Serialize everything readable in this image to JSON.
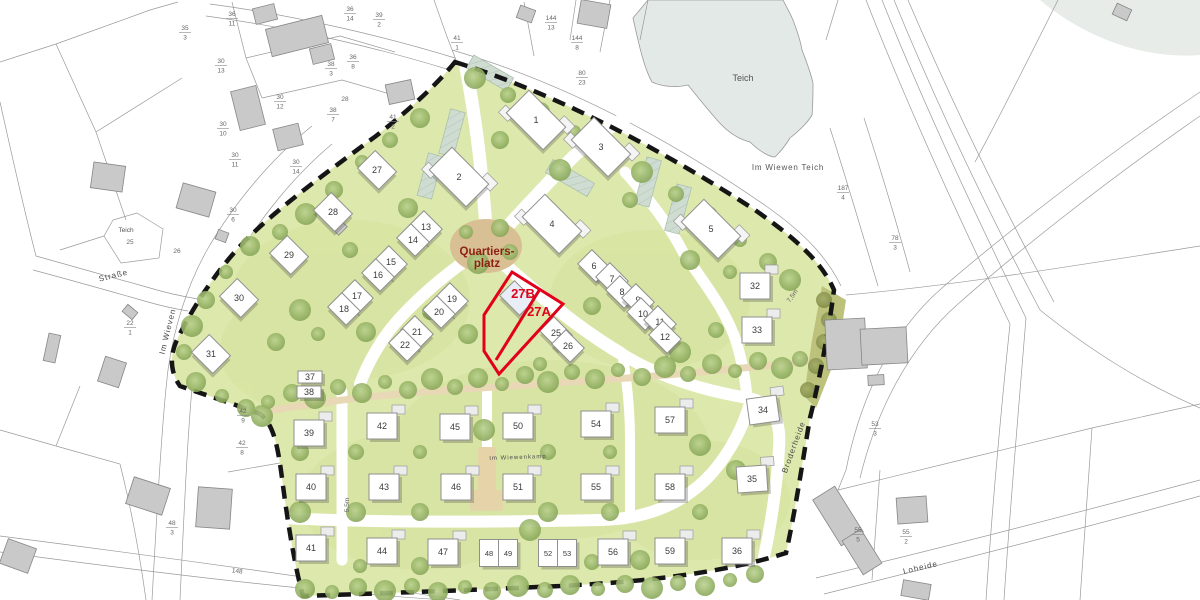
{
  "map": {
    "plaza": {
      "line1": "Quartiers-",
      "line2": "platz",
      "x": 487,
      "y": 255,
      "color": "#8e2012"
    },
    "highlight": {
      "color": "#e2001a",
      "plots": [
        {
          "label": "27B",
          "x": 523,
          "y": 298
        },
        {
          "label": "27A",
          "x": 539,
          "y": 316
        }
      ]
    },
    "water": {
      "pond_label": "Teich",
      "pond_x": 743,
      "pond_y": 81,
      "field_label": "Im Wiewen Teich",
      "field_x": 788,
      "field_y": 170,
      "small_pond_label": "Teich",
      "small_x": 126,
      "small_y": 232
    },
    "streets": [
      {
        "name": "Im Wieven",
        "x": 170,
        "y": 332,
        "rot": -76,
        "size": 8
      },
      {
        "name": "Straße",
        "x": 114,
        "y": 278,
        "rot": -14,
        "size": 8
      },
      {
        "name": "Broderheide",
        "x": 796,
        "y": 448,
        "rot": -70,
        "size": 8
      },
      {
        "name": "Loheide",
        "x": 921,
        "y": 570,
        "rot": -13,
        "size": 8
      },
      {
        "name": "Im Wiewenkamp",
        "x": 518,
        "y": 459,
        "rot": -2,
        "size": 6
      }
    ],
    "houses": [
      {
        "n": "1",
        "x": 536,
        "y": 120,
        "t": "b"
      },
      {
        "n": "2",
        "x": 459,
        "y": 177,
        "t": "b"
      },
      {
        "n": "3",
        "x": 601,
        "y": 147,
        "t": "b"
      },
      {
        "n": "4",
        "x": 552,
        "y": 224,
        "t": "b"
      },
      {
        "n": "5",
        "x": 711,
        "y": 229,
        "t": "b"
      },
      {
        "n": "6",
        "x": 594,
        "y": 266,
        "t": "r"
      },
      {
        "n": "7",
        "x": 612,
        "y": 279,
        "t": "r"
      },
      {
        "n": "8",
        "x": 622,
        "y": 292,
        "t": "r"
      },
      {
        "n": "9",
        "x": 638,
        "y": 300,
        "t": "r"
      },
      {
        "n": "10",
        "x": 643,
        "y": 314,
        "t": "r"
      },
      {
        "n": "11",
        "x": 660,
        "y": 322,
        "t": "r"
      },
      {
        "n": "12",
        "x": 665,
        "y": 337,
        "t": "r"
      },
      {
        "n": "13",
        "x": 426,
        "y": 227,
        "t": "r"
      },
      {
        "n": "14",
        "x": 413,
        "y": 240,
        "t": "r"
      },
      {
        "n": "15",
        "x": 391,
        "y": 262,
        "t": "r"
      },
      {
        "n": "16",
        "x": 378,
        "y": 275,
        "t": "r"
      },
      {
        "n": "17",
        "x": 357,
        "y": 296,
        "t": "r"
      },
      {
        "n": "18",
        "x": 344,
        "y": 309,
        "t": "r"
      },
      {
        "n": "19",
        "x": 452,
        "y": 299,
        "t": "r"
      },
      {
        "n": "20",
        "x": 439,
        "y": 312,
        "t": "r"
      },
      {
        "n": "21",
        "x": 417,
        "y": 332,
        "t": "r"
      },
      {
        "n": "22",
        "x": 405,
        "y": 345,
        "t": "r"
      },
      {
        "n": "25",
        "x": 556,
        "y": 333,
        "t": "r"
      },
      {
        "n": "26",
        "x": 568,
        "y": 346,
        "t": "r"
      },
      {
        "n": "27",
        "x": 377,
        "y": 170,
        "t": "d"
      },
      {
        "n": "28",
        "x": 333,
        "y": 212,
        "t": "d"
      },
      {
        "n": "29",
        "x": 289,
        "y": 255,
        "t": "d"
      },
      {
        "n": "30",
        "x": 239,
        "y": 298,
        "t": "d"
      },
      {
        "n": "31",
        "x": 211,
        "y": 354,
        "t": "d"
      },
      {
        "n": "37",
        "x": 310,
        "y": 377,
        "t": "s"
      },
      {
        "n": "38",
        "x": 309,
        "y": 392,
        "t": "s"
      },
      {
        "n": "32",
        "x": 755,
        "y": 286,
        "t": "g"
      },
      {
        "n": "33",
        "x": 757,
        "y": 330,
        "t": "g"
      },
      {
        "n": "34",
        "x": 763,
        "y": 410,
        "t": "g",
        "r": -8
      },
      {
        "n": "35",
        "x": 752,
        "y": 479,
        "t": "g",
        "r": -4
      },
      {
        "n": "36",
        "x": 737,
        "y": 551,
        "t": "g"
      },
      {
        "n": "39",
        "x": 309,
        "y": 433,
        "t": "g"
      },
      {
        "n": "40",
        "x": 311,
        "y": 487,
        "t": "g"
      },
      {
        "n": "41",
        "x": 311,
        "y": 548,
        "t": "g"
      },
      {
        "n": "42",
        "x": 382,
        "y": 426,
        "t": "g"
      },
      {
        "n": "43",
        "x": 384,
        "y": 487,
        "t": "g"
      },
      {
        "n": "44",
        "x": 382,
        "y": 551,
        "t": "g"
      },
      {
        "n": "45",
        "x": 455,
        "y": 427,
        "t": "g"
      },
      {
        "n": "46",
        "x": 456,
        "y": 487,
        "t": "g"
      },
      {
        "n": "47",
        "x": 443,
        "y": 552,
        "t": "g"
      },
      {
        "n": "48",
        "x": 489,
        "y": 553,
        "t": "n"
      },
      {
        "n": "49",
        "x": 508,
        "y": 553,
        "t": "n"
      },
      {
        "n": "50",
        "x": 518,
        "y": 426,
        "t": "g"
      },
      {
        "n": "51",
        "x": 518,
        "y": 487,
        "t": "g"
      },
      {
        "n": "52",
        "x": 548,
        "y": 553,
        "t": "n"
      },
      {
        "n": "53",
        "x": 567,
        "y": 553,
        "t": "n"
      },
      {
        "n": "54",
        "x": 596,
        "y": 424,
        "t": "g"
      },
      {
        "n": "55",
        "x": 596,
        "y": 487,
        "t": "g"
      },
      {
        "n": "56",
        "x": 613,
        "y": 552,
        "t": "g"
      },
      {
        "n": "57",
        "x": 670,
        "y": 420,
        "t": "g"
      },
      {
        "n": "58",
        "x": 670,
        "y": 487,
        "t": "g"
      },
      {
        "n": "59",
        "x": 670,
        "y": 551,
        "t": "g"
      },
      {
        "n": "",
        "x": 517,
        "y": 298,
        "t": "hl"
      }
    ],
    "parcels": [
      {
        "n": "35",
        "d": "3",
        "x": 185,
        "y": 32
      },
      {
        "n": "36",
        "d": "11",
        "x": 232,
        "y": 18
      },
      {
        "n": "36",
        "d": "14",
        "x": 350,
        "y": 13
      },
      {
        "n": "39",
        "d": "2",
        "x": 379,
        "y": 19
      },
      {
        "n": "41",
        "d": "1",
        "x": 457,
        "y": 42
      },
      {
        "n": "144",
        "d": "13",
        "x": 551,
        "y": 22
      },
      {
        "n": "144",
        "d": "8",
        "x": 577,
        "y": 42
      },
      {
        "n": "80",
        "d": "23",
        "x": 582,
        "y": 77
      },
      {
        "n": "30",
        "d": "13",
        "x": 221,
        "y": 65
      },
      {
        "n": "30",
        "d": "12",
        "x": 280,
        "y": 101
      },
      {
        "n": "30",
        "d": "10",
        "x": 223,
        "y": 128
      },
      {
        "n": "30",
        "d": "11",
        "x": 235,
        "y": 159
      },
      {
        "n": "36",
        "d": "8",
        "x": 353,
        "y": 61
      },
      {
        "n": "38",
        "d": "3",
        "x": 331,
        "y": 68
      },
      {
        "n": "38",
        "d": "7",
        "x": 333,
        "y": 114
      },
      {
        "n": "41",
        "d": "2",
        "x": 393,
        "y": 121
      },
      {
        "n": "30",
        "d": "14",
        "x": 296,
        "y": 166
      },
      {
        "n": "30",
        "d": "6",
        "x": 233,
        "y": 214
      },
      {
        "n": "22",
        "d": "1",
        "x": 130,
        "y": 327
      },
      {
        "n": "42",
        "d": "9",
        "x": 243,
        "y": 415
      },
      {
        "n": "42",
        "d": "8",
        "x": 242,
        "y": 447
      },
      {
        "n": "48",
        "d": "3",
        "x": 172,
        "y": 527
      },
      {
        "n": "187",
        "d": "4",
        "x": 843,
        "y": 192
      },
      {
        "n": "78",
        "d": "3",
        "x": 895,
        "y": 242
      },
      {
        "n": "53",
        "d": "3",
        "x": 875,
        "y": 428
      },
      {
        "n": "55",
        "d": "5",
        "x": 858,
        "y": 534
      },
      {
        "n": "55",
        "d": "2",
        "x": 906,
        "y": 536
      }
    ],
    "notes": [
      {
        "text": "28",
        "x": 345,
        "y": 101,
        "rot": 0
      },
      {
        "text": "26",
        "x": 177,
        "y": 253,
        "rot": 0
      },
      {
        "text": "25",
        "x": 130,
        "y": 244,
        "rot": 0
      },
      {
        "text": "148",
        "x": 237,
        "y": 573,
        "rot": 7
      },
      {
        "text": "7,5m",
        "x": 794,
        "y": 297,
        "rot": -55
      },
      {
        "text": "5,5m",
        "x": 349,
        "y": 505,
        "rot": -90
      }
    ]
  }
}
